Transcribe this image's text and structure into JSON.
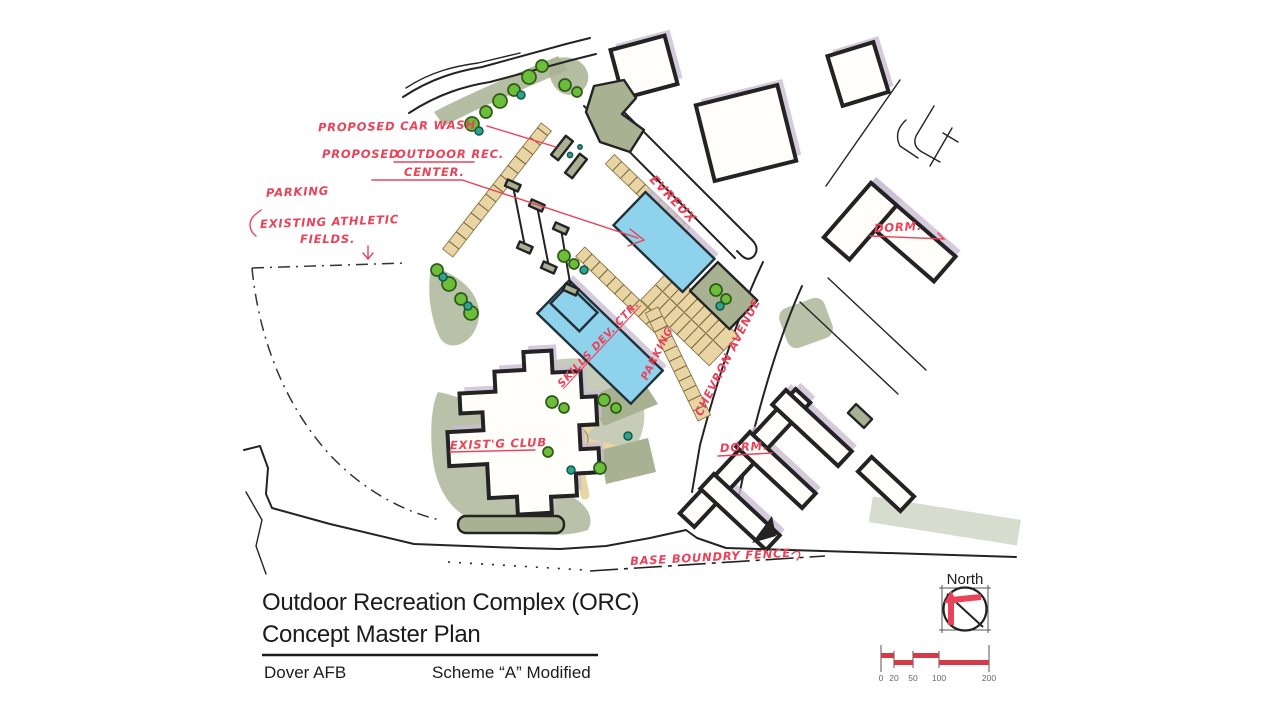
{
  "title_block": {
    "title_line1": "Outdoor Recreation Complex (ORC)",
    "title_line2": "Concept Master Plan",
    "site": "Dover AFB",
    "scheme": "Scheme “A” Modified"
  },
  "north": {
    "label": "North"
  },
  "scale_bar": {
    "ticks": [
      "0",
      "20",
      "50",
      "100",
      "200"
    ]
  },
  "streets": {
    "evreux": "EVREUX",
    "chevron": "CHEVRON  AVENUE"
  },
  "annotations": {
    "proposed_car_wash": "PROPOSED  CAR  WASH",
    "proposed": "PROPOSED",
    "outdoor_rec": "OUTDOOR  REC.",
    "center": "CENTER.",
    "parking_fields": "PARKING",
    "existing_athletic": "EXISTING  ATHLETIC",
    "fields": "FIELDS.",
    "skills_dev_ctr": "SKILLS DEV. CTR.",
    "existg_club": "EXIST'G  CLUB",
    "dorm_upper": "DORM.",
    "dorm_lower": "DORM.",
    "parking_street": "PARKING",
    "base_boundary": "BASE  BOUNDRY  FENCE"
  },
  "colors": {
    "ink": "#232323",
    "red": "#e9435a",
    "blue": "#8ed2ec",
    "tan": "#e9d5a3",
    "sage": "#a8b192",
    "green": "#6cbe3a",
    "teal": "#2ea489",
    "shadow": "#c9bdd2"
  }
}
